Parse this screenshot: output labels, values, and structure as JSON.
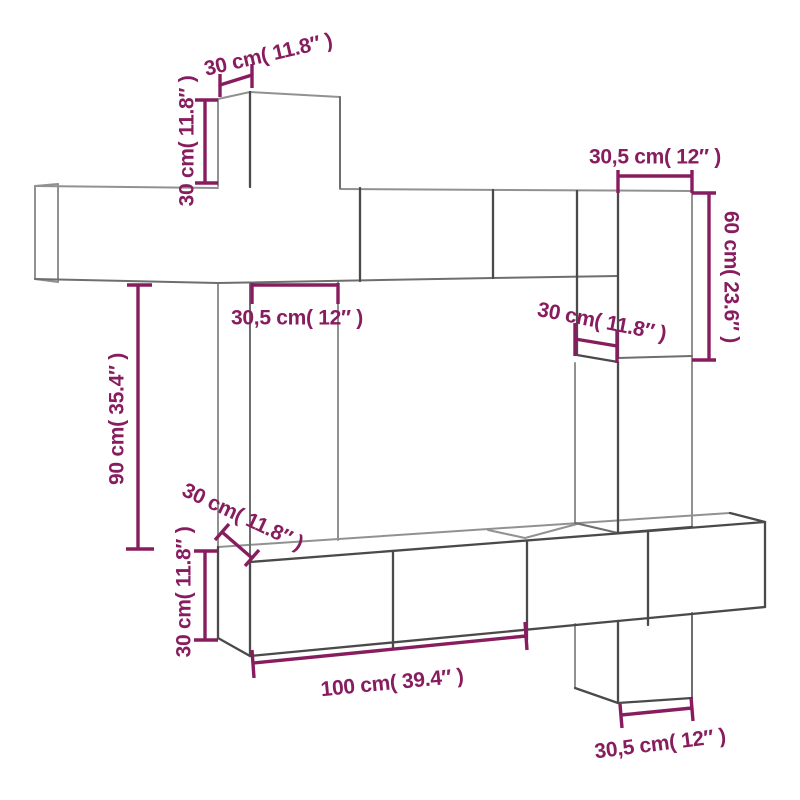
{
  "page": {
    "title": "Wall-mounted furniture set dimension diagram",
    "background": "#ffffff"
  },
  "colors": {
    "dimension": "#871d5f",
    "line_light": "#919191",
    "line_mid": "#6e6e6e",
    "line_dark": "#4a4a4a"
  },
  "diagram": {
    "subject": "wall TV cabinet set line drawing with dimension callouts",
    "labels": {
      "top_box_depth": "30 cm( 11.8″ )",
      "top_box_height": "30 cm( 11.8″ )",
      "top_right_box_width": "30,5 cm( 12″ )",
      "right_box_height": "60 cm( 23.6″ )",
      "left_column_width": "30,5 cm( 12″ )",
      "mid_right_box_height": "30 cm( 11.8″ )",
      "middle_gap_height": "90 cm( 35.4″ )",
      "bottom_left_box_depth": "30 cm( 11.8″ )",
      "bottom_left_box_height": "30 cm( 11.8″ )",
      "tv_bench_width": "100 cm( 39.4″ )",
      "bottom_right_box_width": "30,5 cm( 12″ )"
    }
  }
}
